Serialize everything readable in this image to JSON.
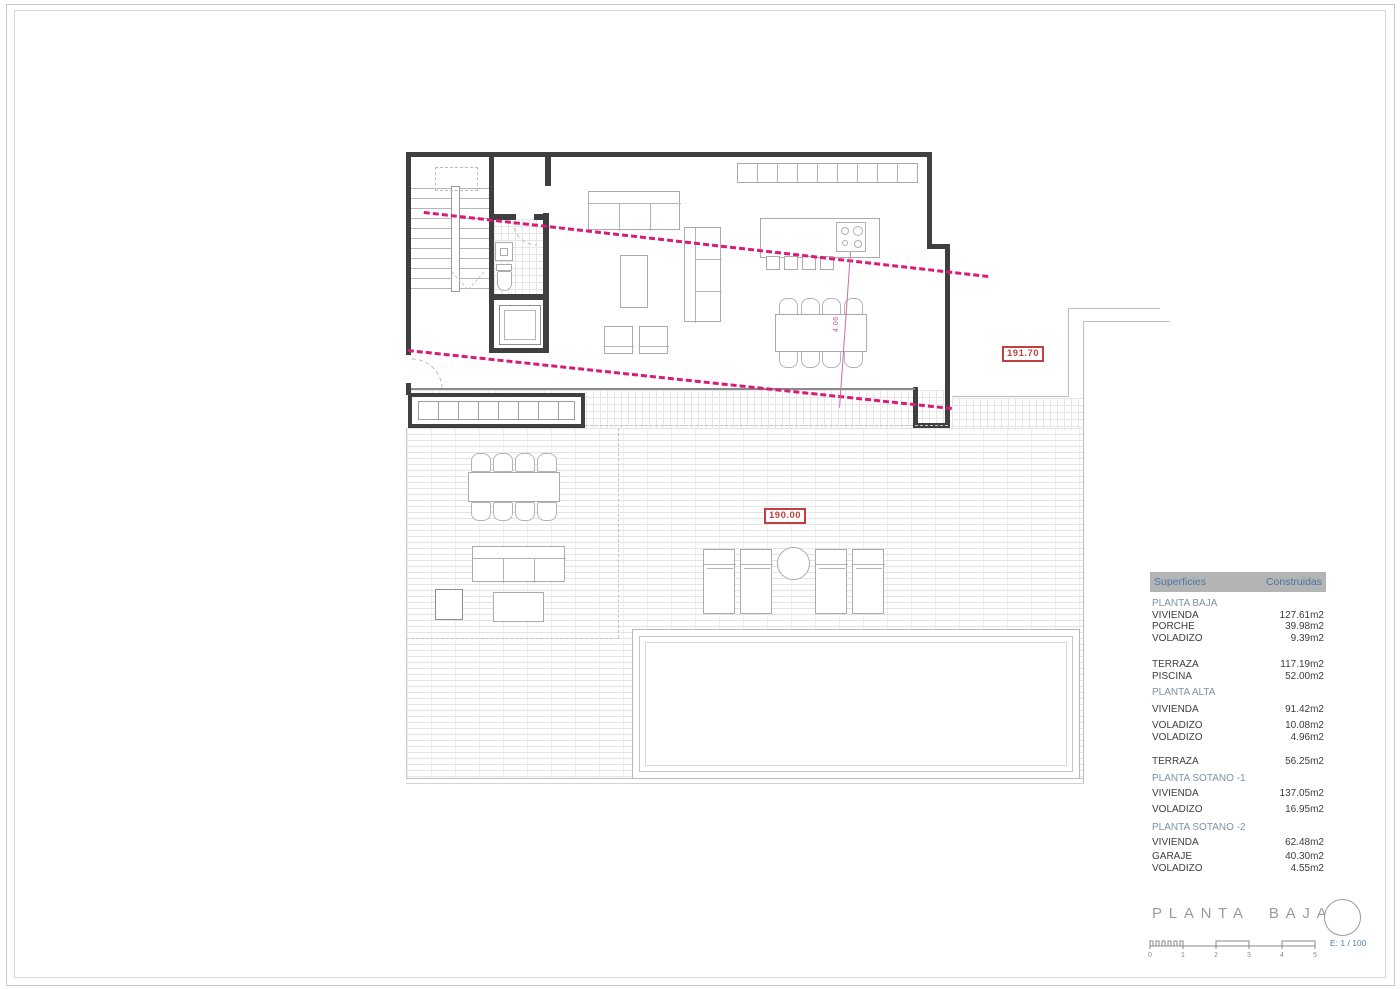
{
  "plan": {
    "dim_label": "4.06",
    "elevation_markers": {
      "upper": "191.70",
      "lower": "190.00"
    }
  },
  "table": {
    "header": {
      "col1": "Superficies",
      "col2": "Construidas"
    },
    "rows": [
      {
        "kind": "section",
        "label": "PLANTA BAJA",
        "value": ""
      },
      {
        "kind": "item",
        "label": "VIVIENDA",
        "value": "127.61m2"
      },
      {
        "kind": "item",
        "label": "PORCHE",
        "value": "39.98m2"
      },
      {
        "kind": "item",
        "label": "VOLADIZO",
        "value": "9.39m2"
      },
      {
        "kind": "item",
        "label": "TERRAZA",
        "value": "117.19m2"
      },
      {
        "kind": "item",
        "label": "PISCINA",
        "value": "52.00m2"
      },
      {
        "kind": "section",
        "label": "PLANTA ALTA",
        "value": ""
      },
      {
        "kind": "item",
        "label": "VIVIENDA",
        "value": "91.42m2"
      },
      {
        "kind": "item",
        "label": "VOLADIZO",
        "value": "10.08m2"
      },
      {
        "kind": "item",
        "label": "VOLADIZO",
        "value": "4.96m2"
      },
      {
        "kind": "item",
        "label": "TERRAZA",
        "value": "56.25m2"
      },
      {
        "kind": "section",
        "label": "PLANTA SOTANO -1",
        "value": ""
      },
      {
        "kind": "item",
        "label": "VIVIENDA",
        "value": "137.05m2"
      },
      {
        "kind": "item",
        "label": "VOLADIZO",
        "value": "16.95m2"
      },
      {
        "kind": "section",
        "label": "PLANTA SOTANO -2",
        "value": ""
      },
      {
        "kind": "item",
        "label": "VIVIENDA",
        "value": "62.48m2"
      },
      {
        "kind": "item",
        "label": "GARAJE",
        "value": "40.30m2"
      },
      {
        "kind": "item",
        "label": "VOLADIZO",
        "value": "4.55m2"
      }
    ]
  },
  "titleblock": {
    "title": "PLANTA BAJA",
    "scale_note": "E: 1 / 100",
    "ticks": [
      "0",
      "1",
      "2",
      "3",
      "4",
      "5"
    ]
  },
  "colors": {
    "setback_magenta": "#d81b7a",
    "elevation_red": "#bf4040",
    "table_header_bg": "#b4b4b4",
    "table_header_text": "#4a76a8",
    "table_section_text": "#7b92a6",
    "title_gray": "#9b9b9b",
    "scale_note_blue": "#5b7ea4"
  }
}
